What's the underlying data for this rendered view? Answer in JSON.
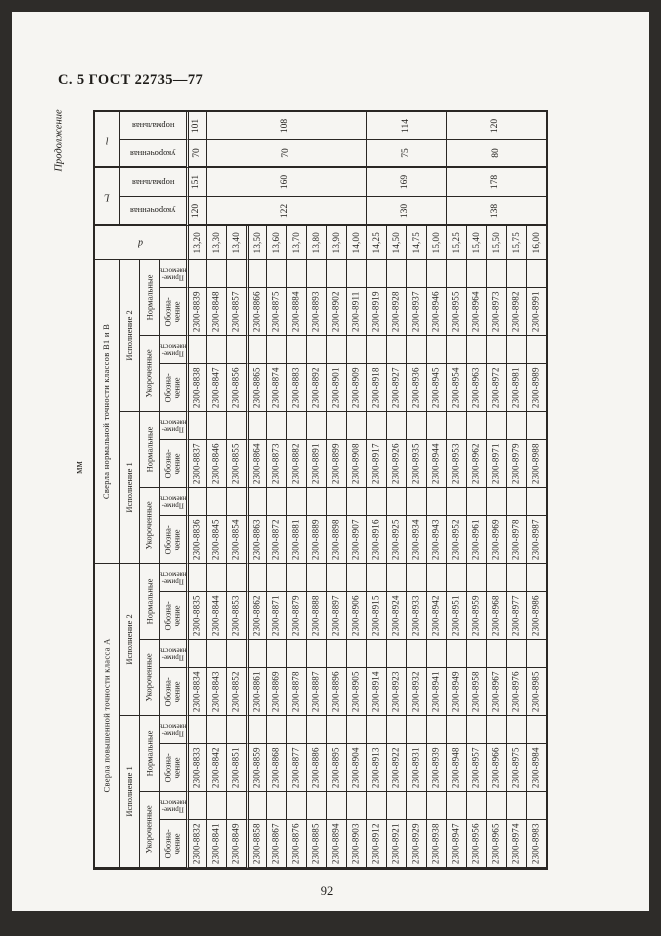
{
  "page": {
    "header": "С. 5 ГОСТ 22735—77",
    "continuation": "Продолжение",
    "units": "мм",
    "page_number": "92"
  },
  "table": {
    "labels": {
      "l_label": "l",
      "L_label": "L",
      "d_label": "d",
      "len_normal": "нормальная",
      "len_short": "укороченная",
      "class_b": "Сверла нормальной точности классов В1 и В",
      "class_a": "Сверла повышенной точности класса А",
      "version1": "Исполнение 1",
      "version2": "Исполнение 2",
      "type_normal": "Нормальные",
      "type_short": "Укороченные",
      "designation": "Обозна-\nчение",
      "applicability": "Приме-\nняемость"
    },
    "d_values": [
      "13,20",
      "13,30",
      "13,40",
      "13,50",
      "13,60",
      "13,70",
      "13,80",
      "13,90",
      "14,00",
      "14,25",
      "14,50",
      "14,75",
      "15,00",
      "15,25",
      "15,40",
      "15,50",
      "15,75",
      "16,00"
    ],
    "lengths": {
      "row_spans": [
        1,
        8,
        4,
        5
      ],
      "l_normal": [
        "101",
        "108",
        "114",
        "120"
      ],
      "l_short": [
        "70",
        "70",
        "75",
        "80"
      ],
      "L_normal": [
        "151",
        "160",
        "169",
        "178"
      ],
      "L_short": [
        "120",
        "122",
        "130",
        "138"
      ]
    },
    "designations": {
      "b2_norm": [
        "2300-8839",
        "2300-8848",
        "2300-8857",
        "2300-8866",
        "2300-8875",
        "2300-8884",
        "2300-8893",
        "2300-8902",
        "2300-8911",
        "2300-8919",
        "2300-8928",
        "2300-8937",
        "2300-8946",
        "2300-8955",
        "2300-8964",
        "2300-8973",
        "2300-8982",
        "2300-8991"
      ],
      "b2_short": [
        "2300-8838",
        "2300-8847",
        "2300-8856",
        "2300-8865",
        "2300-8874",
        "2300-8883",
        "2300-8892",
        "2300-8901",
        "2300-8909",
        "2300-8918",
        "2300-8927",
        "2300-8936",
        "2300-8945",
        "2300-8954",
        "2300-8963",
        "2300-8972",
        "2300-8981",
        "2300-8989"
      ],
      "b1_norm": [
        "2300-8837",
        "2300-8846",
        "2300-8855",
        "2300-8864",
        "2300-8873",
        "2300-8882",
        "2300-8891",
        "2300-8899",
        "2300-8908",
        "2300-8917",
        "2300-8926",
        "2300-8935",
        "2300-8944",
        "2300-8953",
        "2300-8962",
        "2300-8971",
        "2300-8979",
        "2300-8988"
      ],
      "b1_short": [
        "2300-8836",
        "2300-8845",
        "2300-8854",
        "2300-8863",
        "2300-8872",
        "2300-8881",
        "2300-8889",
        "2300-8898",
        "2300-8907",
        "2300-8916",
        "2300-8925",
        "2300-8934",
        "2300-8943",
        "2300-8952",
        "2300-8961",
        "2300-8969",
        "2300-8978",
        "2300-8987"
      ],
      "a2_norm": [
        "2300-8835",
        "2300-8844",
        "2300-8853",
        "2300-8862",
        "2300-8871",
        "2300-8879",
        "2300-8888",
        "2300-8897",
        "2300-8906",
        "2300-8915",
        "2300-8924",
        "2300-8933",
        "2300-8942",
        "2300-8951",
        "2300-8959",
        "2300-8968",
        "2300-8977",
        "2300-8986"
      ],
      "a2_short": [
        "2300-8834",
        "2300-8843",
        "2300-8852",
        "2300-8861",
        "2300-8869",
        "2300-8878",
        "2300-8887",
        "2300-8896",
        "2300-8905",
        "2300-8914",
        "2300-8923",
        "2300-8932",
        "2300-8941",
        "2300-8949",
        "2300-8958",
        "2300-8967",
        "2300-8976",
        "2300-8985"
      ],
      "a1_norm": [
        "2300-8833",
        "2300-8842",
        "2300-8851",
        "2300-8859",
        "2300-8868",
        "2300-8877",
        "2300-8886",
        "2300-8895",
        "2300-8904",
        "2300-8913",
        "2300-8922",
        "2300-8931",
        "2300-8939",
        "2300-8948",
        "2300-8957",
        "2300-8966",
        "2300-8975",
        "2300-8984"
      ],
      "a1_short": [
        "2300-8832",
        "2300-8841",
        "2300-8849",
        "2300-8858",
        "2300-8867",
        "2300-8876",
        "2300-8885",
        "2300-8894",
        "2300-8903",
        "2300-8912",
        "2300-8921",
        "2300-8929",
        "2300-8938",
        "2300-8947",
        "2300-8956",
        "2300-8965",
        "2300-8974",
        "2300-8983"
      ]
    }
  }
}
